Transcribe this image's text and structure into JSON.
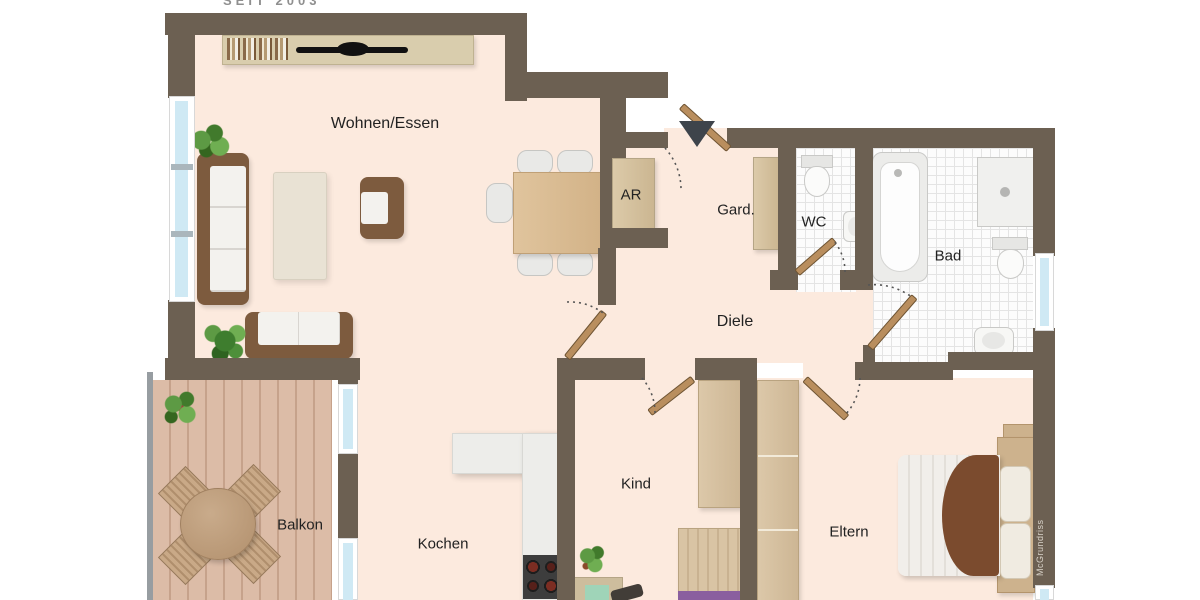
{
  "branding": {
    "top_text": "SEIT 2003",
    "watermark": "McGrundriss"
  },
  "rooms": {
    "wohnen_essen": {
      "label": "Wohnen/Essen"
    },
    "ar": {
      "label": "AR"
    },
    "gard": {
      "label": "Gard."
    },
    "wc": {
      "label": "WC"
    },
    "bad": {
      "label": "Bad"
    },
    "diele": {
      "label": "Diele"
    },
    "kind": {
      "label": "Kind"
    },
    "eltern": {
      "label": "Eltern"
    },
    "kochen": {
      "label": "Kochen"
    },
    "balkon": {
      "label": "Balkon"
    }
  },
  "colors": {
    "wall": "#6c6052",
    "floor": "#fceade",
    "balcony_floor": "#dcbca7",
    "tile_line": "#e4e4e4",
    "glass": "#cfe9f4",
    "wood": "#d8c3a3",
    "sofa_brown": "#7d5b3e",
    "blanket_brown": "#7b4b2e",
    "accent_purple": "#8a5f9f",
    "label": "#222222",
    "outside": "#ffffff"
  }
}
